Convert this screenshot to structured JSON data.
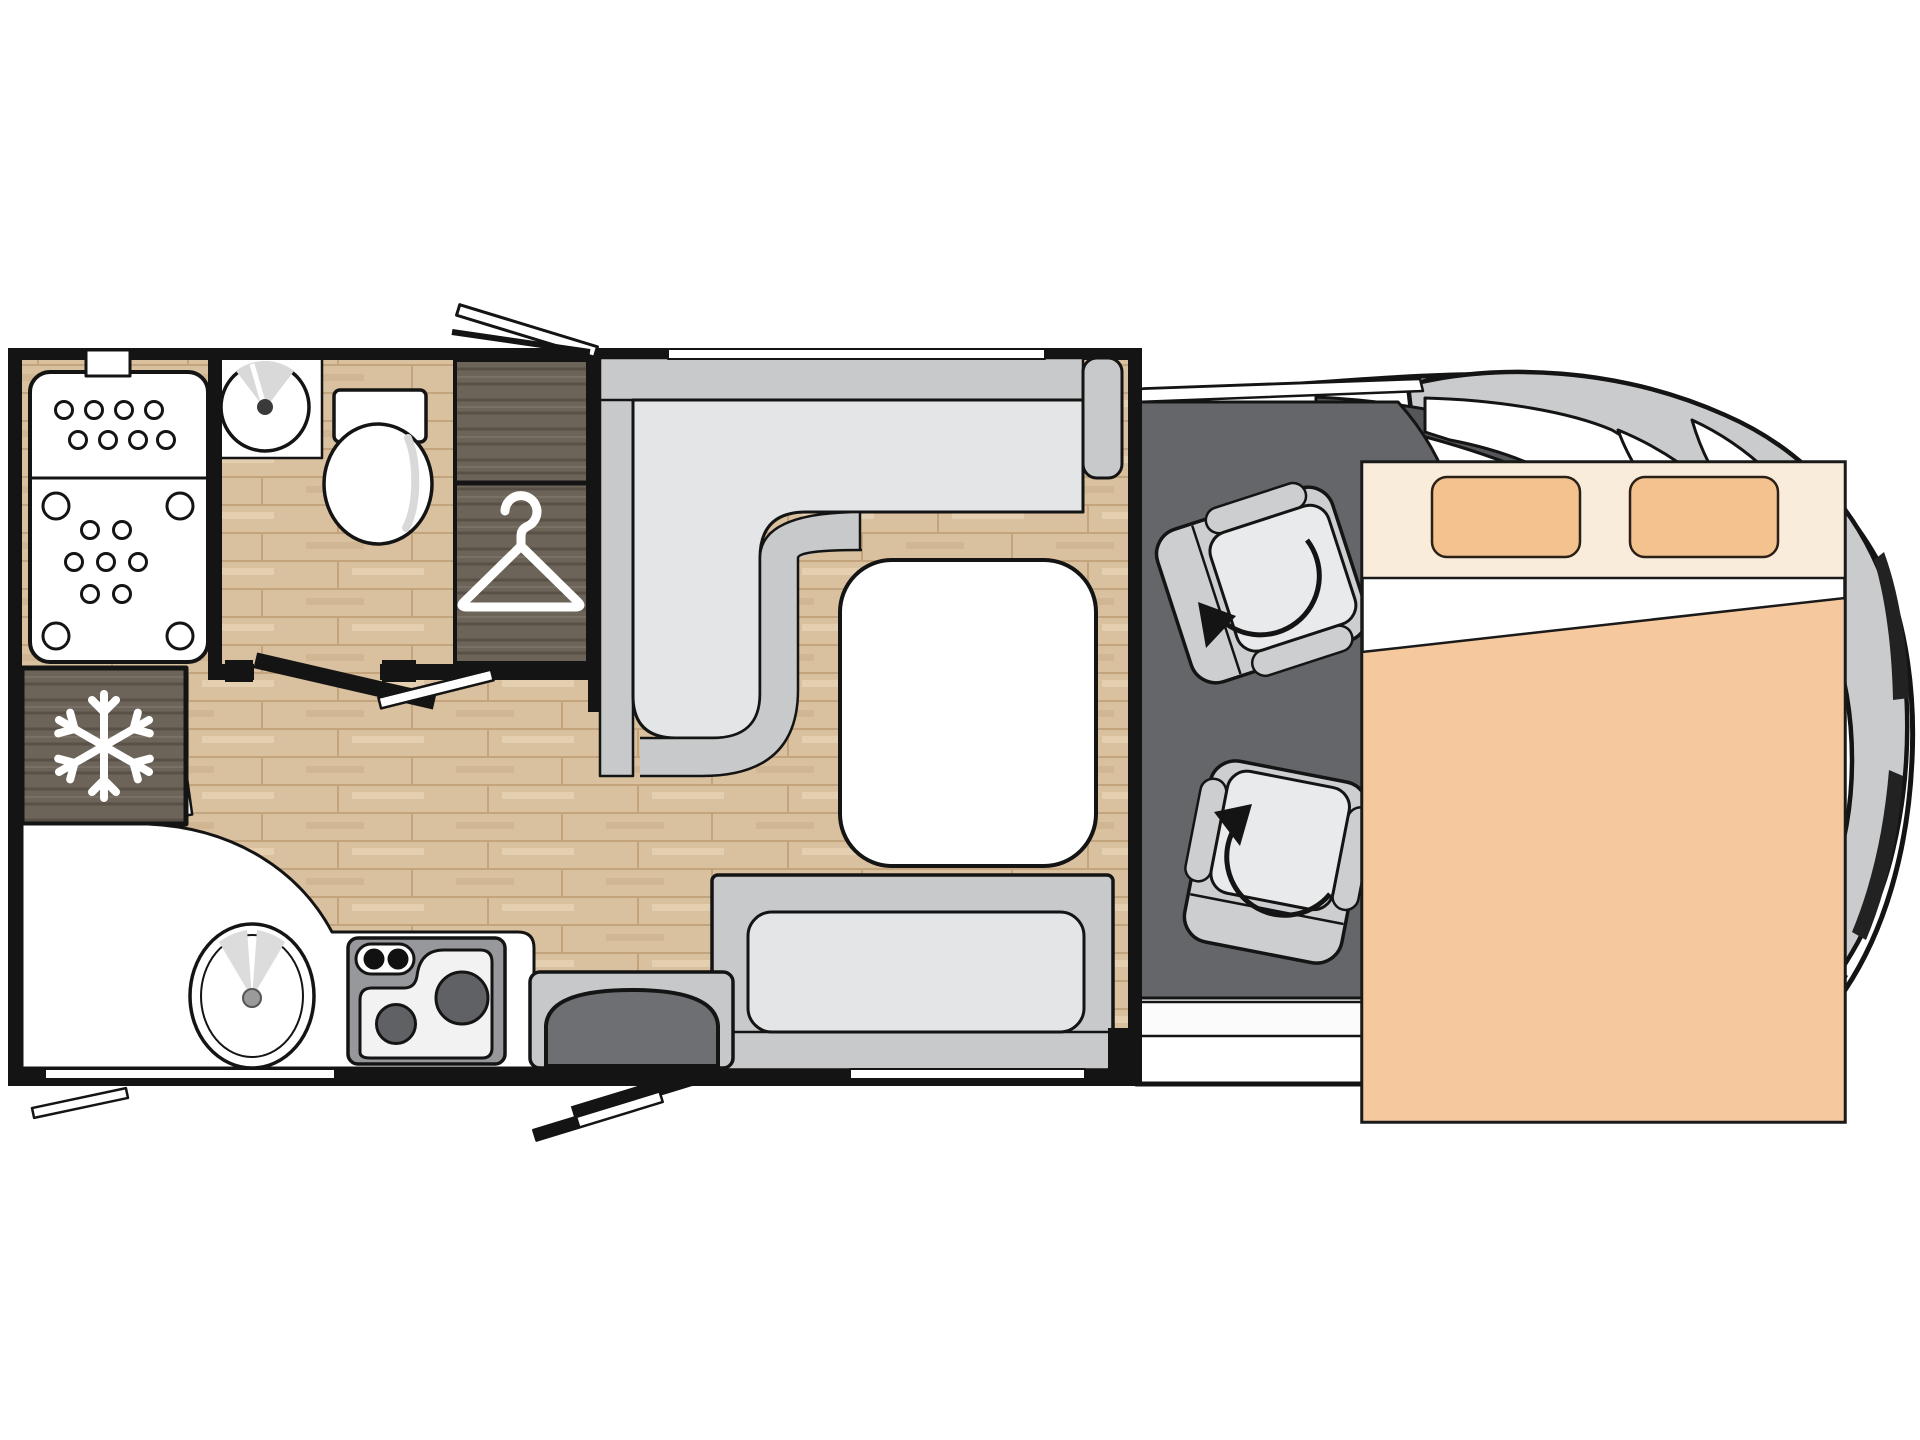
{
  "page": {
    "title": "Motorhome floor plan – top view",
    "background": "#ffffff"
  },
  "floorplan": {
    "label": "Low-profile motorhome layout, top view, cab on the right",
    "vehicle": {
      "body_label": "Vehicle body with windscreen and mirrors",
      "cab_label": "Driver cab with two swivelled captain seats"
    },
    "rooms": [
      {
        "id": "washroom",
        "label": "Rear washroom with shower, washbasin and toilet"
      },
      {
        "id": "wardrobe",
        "label": "Wardrobe with clothes hanger symbol"
      },
      {
        "id": "fridge",
        "label": "Fridge-freezer with snowflake symbol"
      },
      {
        "id": "kitchen",
        "label": "Kitchen unit with round sink and two-burner hob"
      },
      {
        "id": "dinette",
        "label": "L-shaped lounge sofa with pedestal table"
      },
      {
        "id": "bench",
        "label": "Forward-facing travel bench seat"
      },
      {
        "id": "entrance",
        "label": "Habitation entrance with step and open door"
      },
      {
        "id": "cab",
        "label": "Cab area with swivel seats and rotation arrows"
      },
      {
        "id": "bed",
        "label": "Drop-down double bed with two pillows and duvet"
      }
    ],
    "icons": [
      {
        "name": "snowflake-icon",
        "meaning": "fridge / freezer compartment"
      },
      {
        "name": "hanger-icon",
        "meaning": "wardrobe"
      },
      {
        "name": "swivel-arrow-icon",
        "meaning": "seat rotates to face the lounge"
      }
    ],
    "markers": [
      {
        "name": "rooflight-open-marker",
        "meaning": "opening rooflight over washroom"
      },
      {
        "name": "kitchen-window",
        "meaning": "window in rear lower wall"
      },
      {
        "name": "bench-window",
        "meaning": "window behind bench seat"
      },
      {
        "name": "lounge-window",
        "meaning": "window above dinette"
      },
      {
        "name": "rear-window-marker",
        "meaning": "small opening window rear left"
      },
      {
        "name": "entry-door-swing",
        "meaning": "habitation door shown open"
      }
    ],
    "colors": {
      "wall": "#141414",
      "wood": "#d9c09e",
      "wood_line": "#c3a47d",
      "wood_hi": "#ecdcc0",
      "darkwood": "#6d6459",
      "darkwood_dk": "#595147",
      "darkwood_hi": "#7e756a",
      "sofa_band": "#c8c9ca",
      "sofa_seat": "#e4e5e6",
      "cab_floor": "#64666a",
      "body_band": "#c9cbcd",
      "pillar": "#54565a",
      "bed_cream": "#f9ecdb",
      "pillow": "#f3c28f",
      "blanket": "#f6c89d",
      "step": "#6e6f72",
      "step_frame": "#c7c8c9",
      "hob": "#97989b",
      "burner": "#5f6164",
      "seat_gray": "#cdced0",
      "seat_cushion": "#e9eaeb",
      "white": "#ffffff"
    }
  }
}
